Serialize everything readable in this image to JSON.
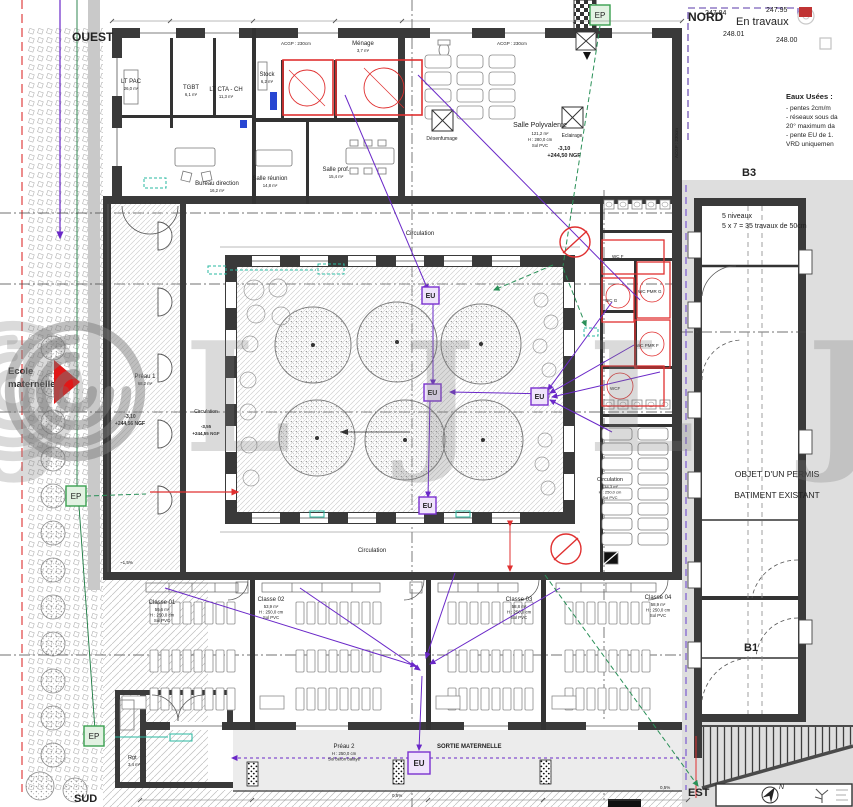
{
  "orientation": {
    "nord": "NORD",
    "ouest": "OUEST",
    "sud": "SUD",
    "est": "EST"
  },
  "zones": {
    "en_travaux": "En travaux",
    "b3": "B3",
    "b1": "B1",
    "ecole_l1": "Ecole",
    "ecole_l2": "maternelle",
    "sortie_maternelle": "SORTIE MATERNELLE"
  },
  "levels": {
    "t1": "247.84",
    "t2": "247.95",
    "t3": "248.01",
    "t4": "248.00",
    "salle_niv": "-3,10",
    "salle_ngf": "+244,50 NGF",
    "preau_niv": "-3,10",
    "preau_ngf": "+244,56 NGF",
    "circ_niv": "-3,55",
    "circ_ngf": "+244,55 NGF"
  },
  "notes": {
    "eaux_title": "Eaux Usées :",
    "eaux_l1": "- pentes 2cm/m",
    "eaux_l2": "- réseaux sous da",
    "eaux_l3": "20° maximum da",
    "eaux_l4": "- pente EU  de 1.",
    "eaux_l5": "VRD uniquemen",
    "permis_l1": "OBJET D'UN PERMIS",
    "permis_l2": "BATIMENT EXISTANT",
    "niveaux_l1": "5 niveaux",
    "niveaux_l2": "5 x 7 = 35 travaux de 50cm"
  },
  "rooms": {
    "lt_pac": "LT PAC",
    "lt_pac_a": "26,0 m²",
    "tgbt": "TGBT",
    "tgbt_a": "6,1 m²",
    "lt_cta": "LT CTA - CH",
    "lt_cta_a": "11,3 m²",
    "bureau": "Bureau direction",
    "bureau_a": "16,2 m²",
    "reunion": "Salle réunion",
    "reunion_a": "14,8 m²",
    "stock": "Stock",
    "stock_a": "6,2 m²",
    "menage": "Ménage",
    "menage_a": "3,7 m²",
    "prof": "Salle prof.",
    "prof_a": "15,4 m²",
    "poly": "Salle Polyvalente",
    "poly_a": "121,2 m²",
    "poly_h": "H : 280,0 cm",
    "poly_s": "Sol PVC",
    "desenfumage": "Désenfumage",
    "eclairage": "Eclairage",
    "preau1": "Préau 1",
    "preau1_a": "68,2 m²",
    "preau2": "Préau 2",
    "preau2_h": "H : 250,0 cm",
    "preau2_s": "Sol béton balayé",
    "rgt": "Rgt",
    "rgt_a": "3,4 m²",
    "c1": "Classe 01",
    "c1_a": "59,6 m²",
    "c2": "Classe 02",
    "c2_a": "53,9 m²",
    "c3": "Classe 03",
    "c3_a": "58,8 m²",
    "c4": "Classe 04",
    "c4_a": "58,9 m²",
    "class_h": "H : 250,0 cm",
    "class_s": "Sol PVC",
    "circulation": "Circulation",
    "circ_a": "144,3 m²",
    "wc_f": "WC F",
    "wc_g": "WC G",
    "wc_pmr_g": "WC PMR G",
    "wc_pmr_f": "WC PMR F",
    "wcf": "WCF"
  },
  "markers": {
    "eu": "EU",
    "ep": "EP",
    "acgp": "ACGP : 230cm",
    "slope1": "0,5%",
    "slope2": "~1,5%",
    "compass_n": "N"
  },
  "watermark": {
    "j": "J",
    "l": "L"
  }
}
